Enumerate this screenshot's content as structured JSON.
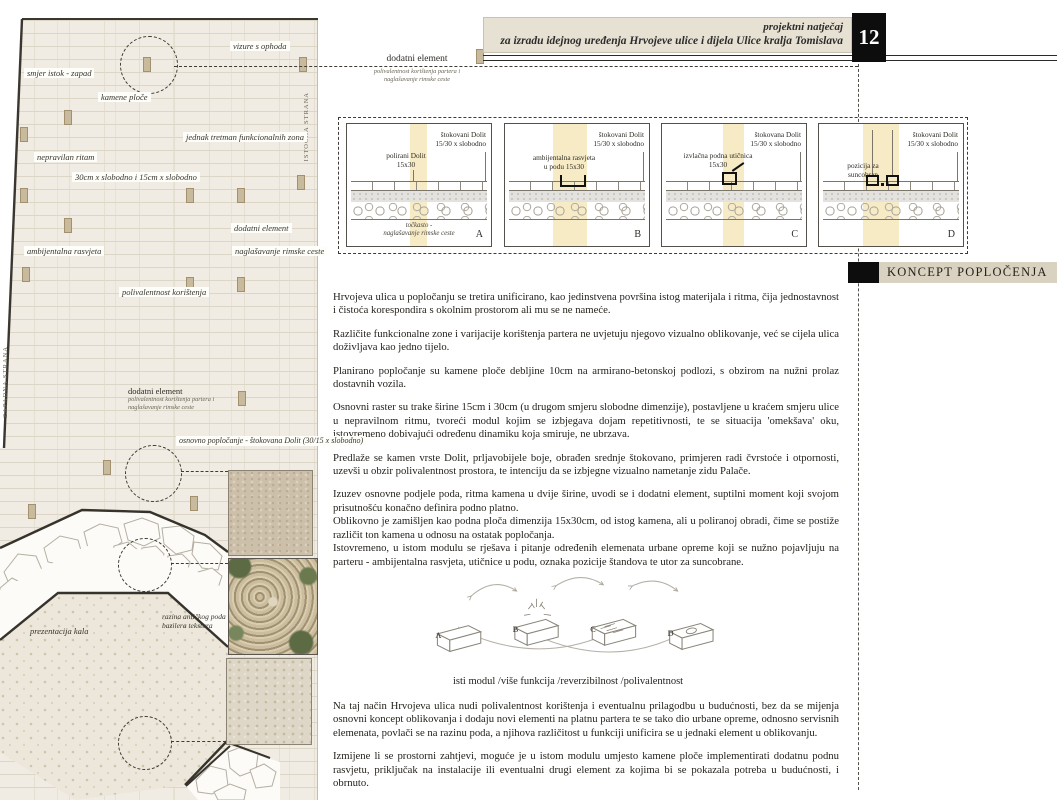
{
  "header": {
    "title_line1": "projektni natječaj",
    "title_line2": "za izradu idejnog uređenja Hrvojeve ulice i dijela Ulice kralja Tomislava",
    "page_number": "12"
  },
  "section": {
    "title": "KONCEPT POPLOČENJA"
  },
  "plan": {
    "labels": {
      "vizure": "vizure s ophoda",
      "smjer": "smjer istok - zapad",
      "kamene": "kamene ploče",
      "istocna": "ISTOČNA STRANA",
      "zapadna": "ZAPADNA STRANA",
      "jednak": "jednak tretman funkcionalnih zona",
      "nepravilan": "nepravilan ritam",
      "trake": "30cm x slobodno i 15cm x slobodno",
      "dodatni": "dodatni element",
      "ambijentalna": "ambijentalna rasvjeta",
      "naglasavanje": "naglašavanje rimske ceste",
      "polivalentnost": "polivalentnost korištenja",
      "dodatni2": "dodatni element",
      "dodatni2_sub1": "polivalentnost korištenja partera i",
      "dodatni2_sub2": "naglašavanje rimske ceste",
      "osnovno": "osnovno popločanje - štokovana Dolit (30/15 x slobodno)",
      "razina1": "razina antičkog poda",
      "razina2": "bazilera tekstura",
      "prezentacija": "prezentacija kala"
    }
  },
  "top_note": {
    "title": "dodatni element",
    "sub1": "polivalentnost korištenja partera i",
    "sub2": "naglašavanje rimske ceste"
  },
  "panels": [
    {
      "letter": "A",
      "right1": "štokovani Dolit",
      "right2": "15/30 x slobodno",
      "left1": "polirani Dolit",
      "left2": "15x30",
      "note1": "točkasto -",
      "note2": "naglašavanje rimske ceste"
    },
    {
      "letter": "B",
      "right1": "štokovani Dolit",
      "right2": "15/30 x slobodno",
      "left1": "ambijentalna rasvjeta",
      "left2": "u podu 15x30"
    },
    {
      "letter": "C",
      "right1": "štokovana Dolit",
      "right2": "15/30 x slobodno",
      "left1": "izvlačna podna utičnica",
      "left2": "15x30"
    },
    {
      "letter": "D",
      "right1": "štokovani Dolit",
      "right2": "15/30 x slobodno",
      "left1": "pozicija za",
      "left2": "suncobran"
    }
  ],
  "body": {
    "p1": "Hrvojeva ulica u popločanju se tretira unificirano, kao jedinstvena površina istog materijala i ritma, čija jednostavnost i čistoća korespondira s okolnim prostorom ali mu se ne nameće.",
    "p2": "Različite funkcionalne zone i varijacije korištenja partera ne uvjetuju njegovo vizualno oblikovanje, već se cijela ulica doživljava kao jedno tijelo.",
    "p3": "Planirano popločanje su kamene ploče debljine 10cm na armirano-betonskoj podlozi, s obzirom na nužni prolaz dostavnih vozila.",
    "p4": "Osnovni raster su trake širine 15cm i 30cm (u drugom smjeru slobodne dimenzije), postavljene u kraćem smjeru ulice u nepravilnom ritmu, tvoreći modul kojim se izbjegava dojam repetitivnosti, te se situacija 'omekšava' oku, istovremeno dobivajući određenu dinamiku koja smiruje, ne ubrzava.",
    "p5": "Predlaže se kamen vrste Dolit, prljavobijele boje, obrađen srednje štokovano, primjeren radi čvrstoće i otpornosti, uzevši u obzir polivalentnost prostora, te intenciju da se izbjegne vizualno nametanje zidu Palače.",
    "p6": "Izuzev osnovne podjele poda, ritma kamena u dvije širine, uvodi se i dodatni element, suptilni moment koji svojom prisutnošću konačno definira podno platno.",
    "p7": "Oblikovno je zamišljen kao podna ploča dimenzija 15x30cm, od istog kamena, ali u poliranoj obradi, čime se postiže različit ton kamena u odnosu na ostatak popločanja.",
    "p8": "Istovremeno, u istom modulu se rješava i pitanje određenih elemenata urbane opreme koji se nužno pojavljuju na parteru - ambijentalna rasvjeta, utičnice u podu, oznaka pozicije štandova te utor za suncobrane.",
    "p9": "Na taj način Hrvojeva ulica nudi polivalentnost korištenja i eventualnu prilagodbu u budućnosti, bez da se mijenja osnovni koncept oblikovanja i dodaju novi elementi na platnu partera te se tako dio urbane opreme, odnosno servisnih elemenata, povlači se na razinu poda, a njihova različitost u funkciji unificira se u jednaki element u oblikovanju.",
    "p10": "Izmijene li se prostorni zahtjevi, moguće je u istom modulu umjesto kamene ploče implementirati dodatnu podnu rasvjetu, priključak na instalacije ili eventualni drugi element za kojima bi se pokazala potreba u budućnosti, i obrnuto."
  },
  "diagram": {
    "letters": [
      "A",
      "B",
      "C",
      "D"
    ],
    "caption": "isti modul /više funkcija /reverzibilnost /polivalentnost"
  },
  "colors": {
    "highlight_yellow": "#f2e2a4",
    "board_beige": "#e7e1d3",
    "section_beige": "#d9d2c0",
    "ink_black": "#0d0d0d",
    "tile_tan": "#c8ba9d"
  }
}
